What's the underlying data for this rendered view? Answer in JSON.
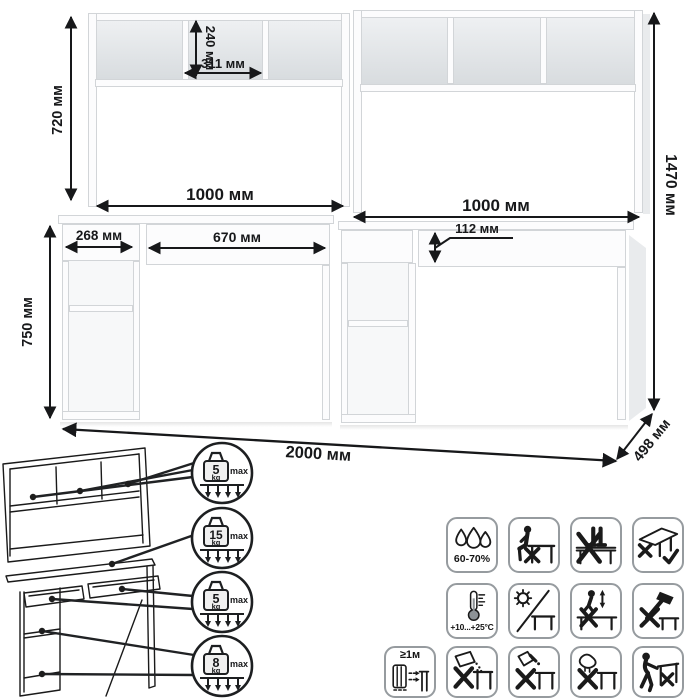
{
  "dimensions": {
    "hutch_height": "720 мм",
    "cubby_height": "240 мм",
    "cubby_width": "311 мм",
    "left_desk_width": "1000 мм",
    "right_desk_width": "1000 мм",
    "total_height": "1470 мм",
    "side_drawer_width": "268 мм",
    "center_drawer_width": "670 мм",
    "drawer_height": "112 мм",
    "desk_height": "750 мм",
    "total_width": "2000 мм",
    "depth": "498 мм"
  },
  "load_callouts": [
    {
      "value": "5",
      "unit": "kg",
      "note": "max",
      "target": "hutch-shelves"
    },
    {
      "value": "15",
      "unit": "kg",
      "note": "max",
      "target": "desktop"
    },
    {
      "value": "5",
      "unit": "kg",
      "note": "max",
      "target": "drawers"
    },
    {
      "value": "8",
      "unit": "kg",
      "note": "max",
      "target": "side-shelves"
    }
  ],
  "care_labels": {
    "humidity": "60-70%",
    "temperature": "+10...+25°C",
    "radiator_distance": "≥1м"
  },
  "care_icons": {
    "row1": [
      "humidity",
      "no-sitting-on-table",
      "no-standing-on-table",
      "move-disassembled"
    ],
    "row2": [
      "temperature-range",
      "no-direct-sunlight",
      "no-jumping-on-table",
      "no-hammering"
    ],
    "row3": [
      "keep-distance-from-radiator",
      "no-abrasive-cleaners",
      "no-solvents",
      "no-wet-cloth",
      "no-dragging"
    ]
  },
  "colors": {
    "line": "#17181a",
    "panel_edge": "#d2d5d8",
    "compartment_back": "#dcdfe2"
  }
}
